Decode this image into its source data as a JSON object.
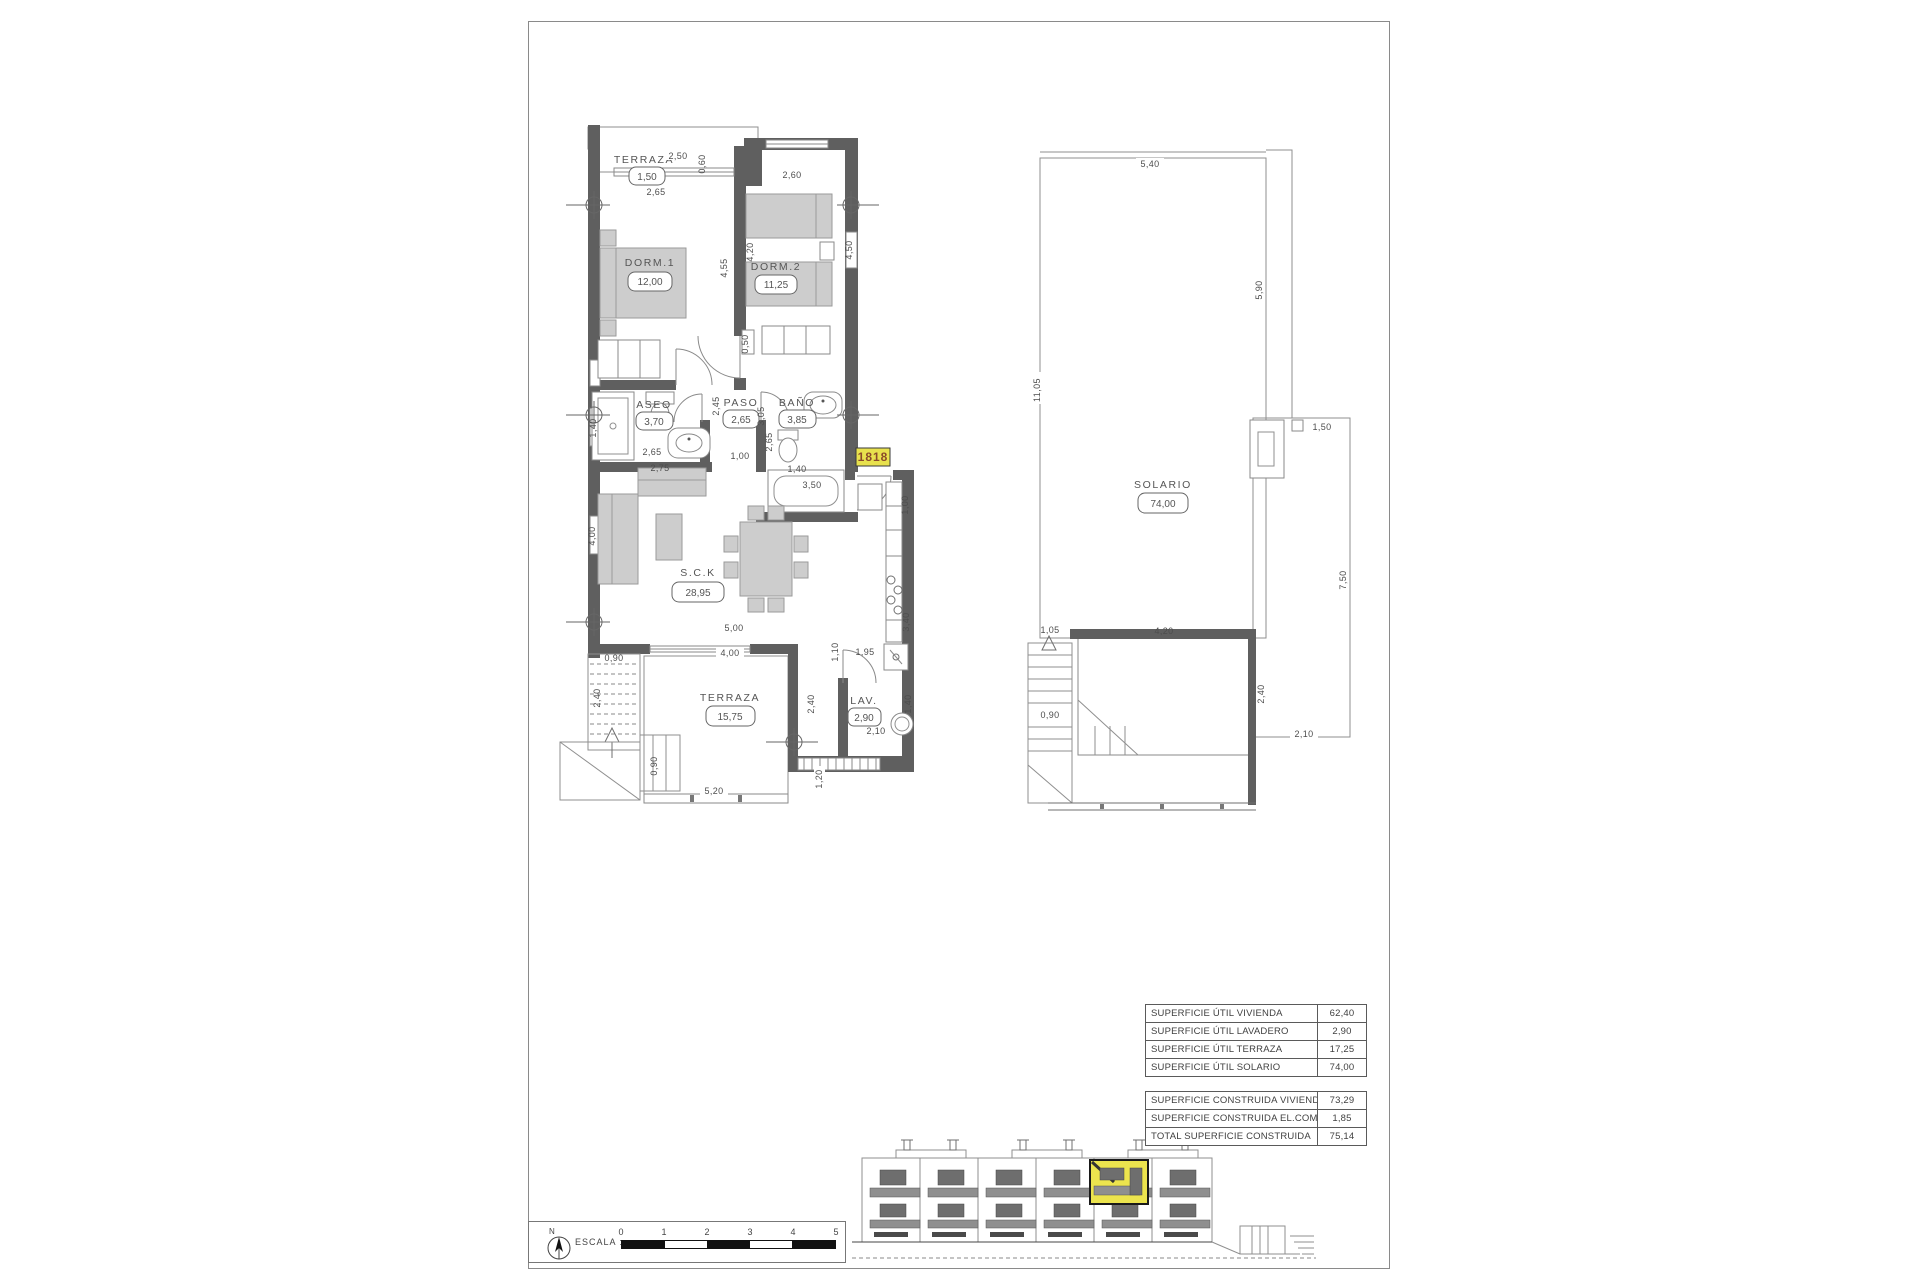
{
  "sheet": {
    "unit_tag": "1818"
  },
  "apt": {
    "rooms": {
      "terraza_top": {
        "name": "TERRAZA",
        "area": "1,50"
      },
      "dorm1": {
        "name": "DORM.1",
        "area": "12,00"
      },
      "dorm2": {
        "name": "DORM.2",
        "area": "11,25"
      },
      "aseo": {
        "name": "ASEO",
        "area": "3,70"
      },
      "paso": {
        "name": "PASO",
        "area": "2,65"
      },
      "bano": {
        "name": "BAÑO",
        "area": "3,85"
      },
      "sck": {
        "name": "S.C.K",
        "area": "28,95"
      },
      "terraza": {
        "name": "TERRAZA",
        "area": "15,75"
      },
      "lav": {
        "name": "LAV.",
        "area": "2,90"
      }
    },
    "dims": {
      "terraza_w": "2,50",
      "terraza_d": "0,60",
      "terraza_in": "2,65",
      "dorm2_w": "2,60",
      "dorm1_h": "4,55",
      "dorm2_h": "4,20",
      "dorm2_win": "4,50",
      "closet": "0,50",
      "aseo_side": "1,40",
      "aseo_w": "2,65",
      "sofa": "2,75",
      "paso_a": "2,45",
      "paso_b": "3,05",
      "bano_side": "2,65",
      "hall": "1,00",
      "bath": "1,40",
      "bano_w": "3,50",
      "entry": "1,00",
      "sck_h": "4,00",
      "sck_w": "5,00",
      "terr_w": "4,00",
      "stairs_w": "0,90",
      "stairs_h": "2,40",
      "kitchen_a": "1,10",
      "kitchen_b": "1,95",
      "kitchen_h": "3,40",
      "terr_h": "2,40",
      "terr_edge": "1,20",
      "terr_bottom": "5,20",
      "stairs_b": "0,90",
      "lav_w": "2,10",
      "lav_h": "1,40"
    }
  },
  "sol": {
    "room": {
      "name": "SOLARIO",
      "area": "74,00"
    },
    "dims": {
      "top": "5,40",
      "right": "5,90",
      "left": "11,05",
      "chimney": "1,50",
      "right2": "7,50",
      "stairs_top": "1,05",
      "void_w": "4,20",
      "stairs": "0,90",
      "ext_h": "2,40",
      "ext_w": "2,10"
    }
  },
  "tables": {
    "util": [
      {
        "label": "SUPERFICIE ÚTIL VIVIENDA",
        "value": "62,40"
      },
      {
        "label": "SUPERFICIE ÚTIL LAVADERO",
        "value": "2,90"
      },
      {
        "label": "SUPERFICIE ÚTIL TERRAZA",
        "value": "17,25"
      },
      {
        "label": "SUPERFICIE ÚTIL SOLARIO",
        "value": "74,00"
      }
    ],
    "construida": [
      {
        "label": "SUPERFICIE CONSTRUIDA VIVIENDA",
        "value": "73,29"
      },
      {
        "label": "SUPERFICIE CONSTRUIDA EL.COMUNES",
        "value": "1,85"
      },
      {
        "label": "TOTAL SUPERFICIE CONSTRUIDA",
        "value": "75,14"
      }
    ]
  },
  "footer": {
    "north": "N",
    "escala": "ESCALA :",
    "ticks": [
      "0",
      "1",
      "2",
      "3",
      "4",
      "5"
    ]
  },
  "colors": {
    "highlight": "#ece44e",
    "wall": "#5f5f5f"
  }
}
